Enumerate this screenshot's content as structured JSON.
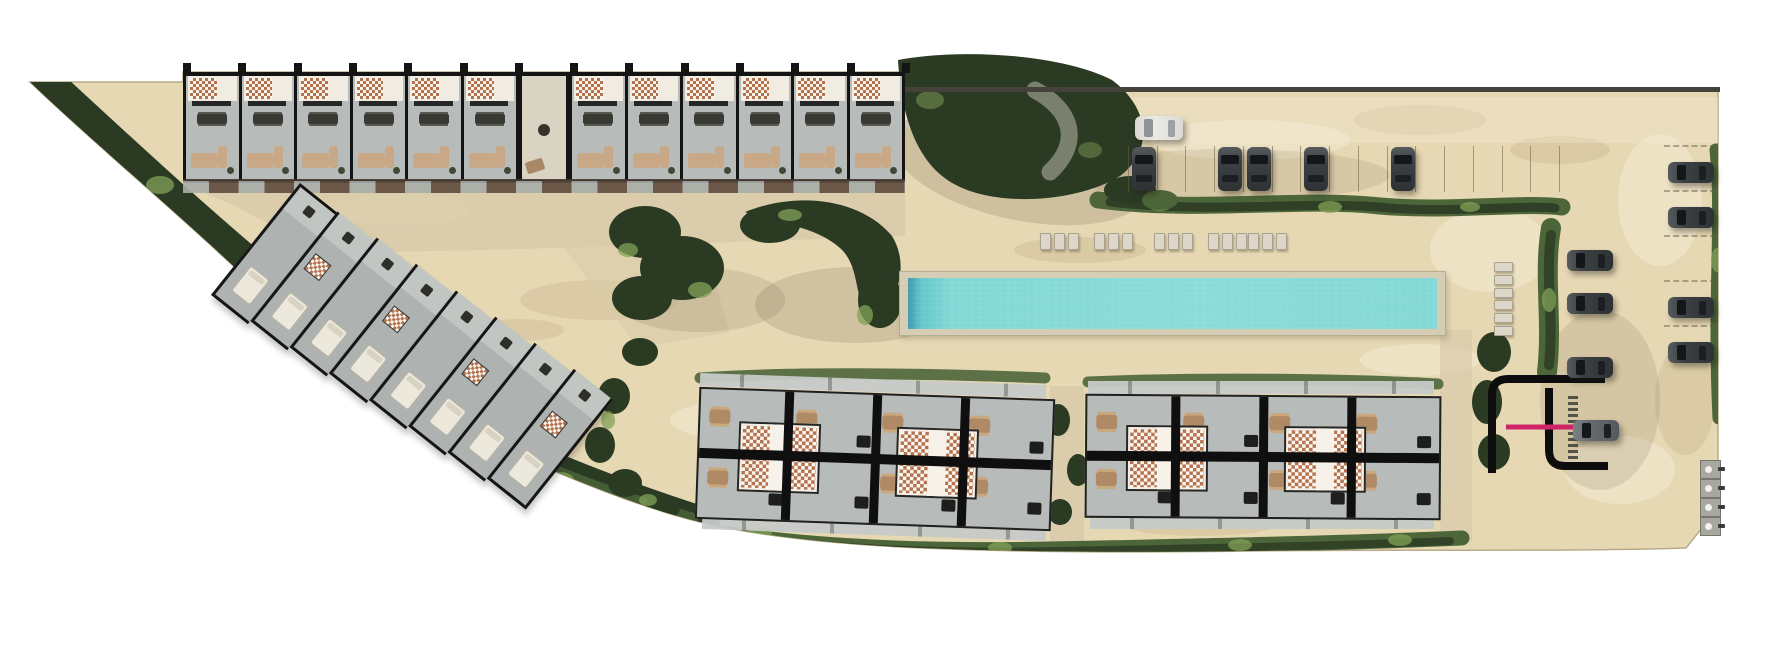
{
  "meta": {
    "title": "Residential development site plan — aerial masterplan rendering",
    "plan_type": "architectural site plan",
    "no_visible_text": true
  },
  "colors": {
    "sand": "#e7d8b4",
    "sand-light": "#f4ebd3",
    "sand-dark": "#c9b68e",
    "gravel": "#d8cba9",
    "veg-dark": "#2a3a23",
    "veg-mid": "#4c6639",
    "veg-light": "#82a257",
    "floor": "#b7bbba",
    "tile": "#b5724f",
    "sofa": "#c9a887",
    "deck": "#d6cdb5",
    "water": "#82d8d5",
    "gate-pink": "#cf2568",
    "asphalt": "#0d0d0d"
  },
  "site": {
    "label": "Triangular coastal parcel, white background outside boundary",
    "utility_pads": 4
  },
  "buildings": {
    "top_row": {
      "label": "Townhouse row A with central entrance lobby",
      "units_left": 6,
      "units_right": 6,
      "lobby_label": "Entrance lobby"
    },
    "diagonal_row": {
      "label": "Townhouse row B, rotated along west boundary",
      "units": 8
    },
    "cluster_left": {
      "label": "Villa cluster C with two tiled courtyards",
      "units": 8,
      "divider_walls": 3
    },
    "cluster_right": {
      "label": "Villa cluster D with two tiled courtyards",
      "units": 8,
      "divider_walls": 3
    }
  },
  "amenities": {
    "pool_label": "Long lap pool with stone deck",
    "lounger_group_x": [
      1040,
      1094,
      1154,
      1208,
      1248
    ],
    "side_lounger_y": [
      262,
      300
    ]
  },
  "parking": {
    "top_lot": {
      "label": "North parking row",
      "stalls": 16,
      "car_stall_indices": [
        1,
        4,
        5,
        7,
        10
      ],
      "white_car": 1
    },
    "right_lot": {
      "label": "East parking column",
      "stalls": 5,
      "car_stall_indices": [
        0,
        1,
        3,
        4
      ]
    },
    "inner_car_y": [
      250,
      293,
      357
    ],
    "entrance_car": 1
  },
  "entrance": {
    "label": "Gated site entrance with pink barrier arm and crosswalk"
  },
  "counts": {
    "top_row_ticks": 14,
    "cluster_dividers": 3
  }
}
